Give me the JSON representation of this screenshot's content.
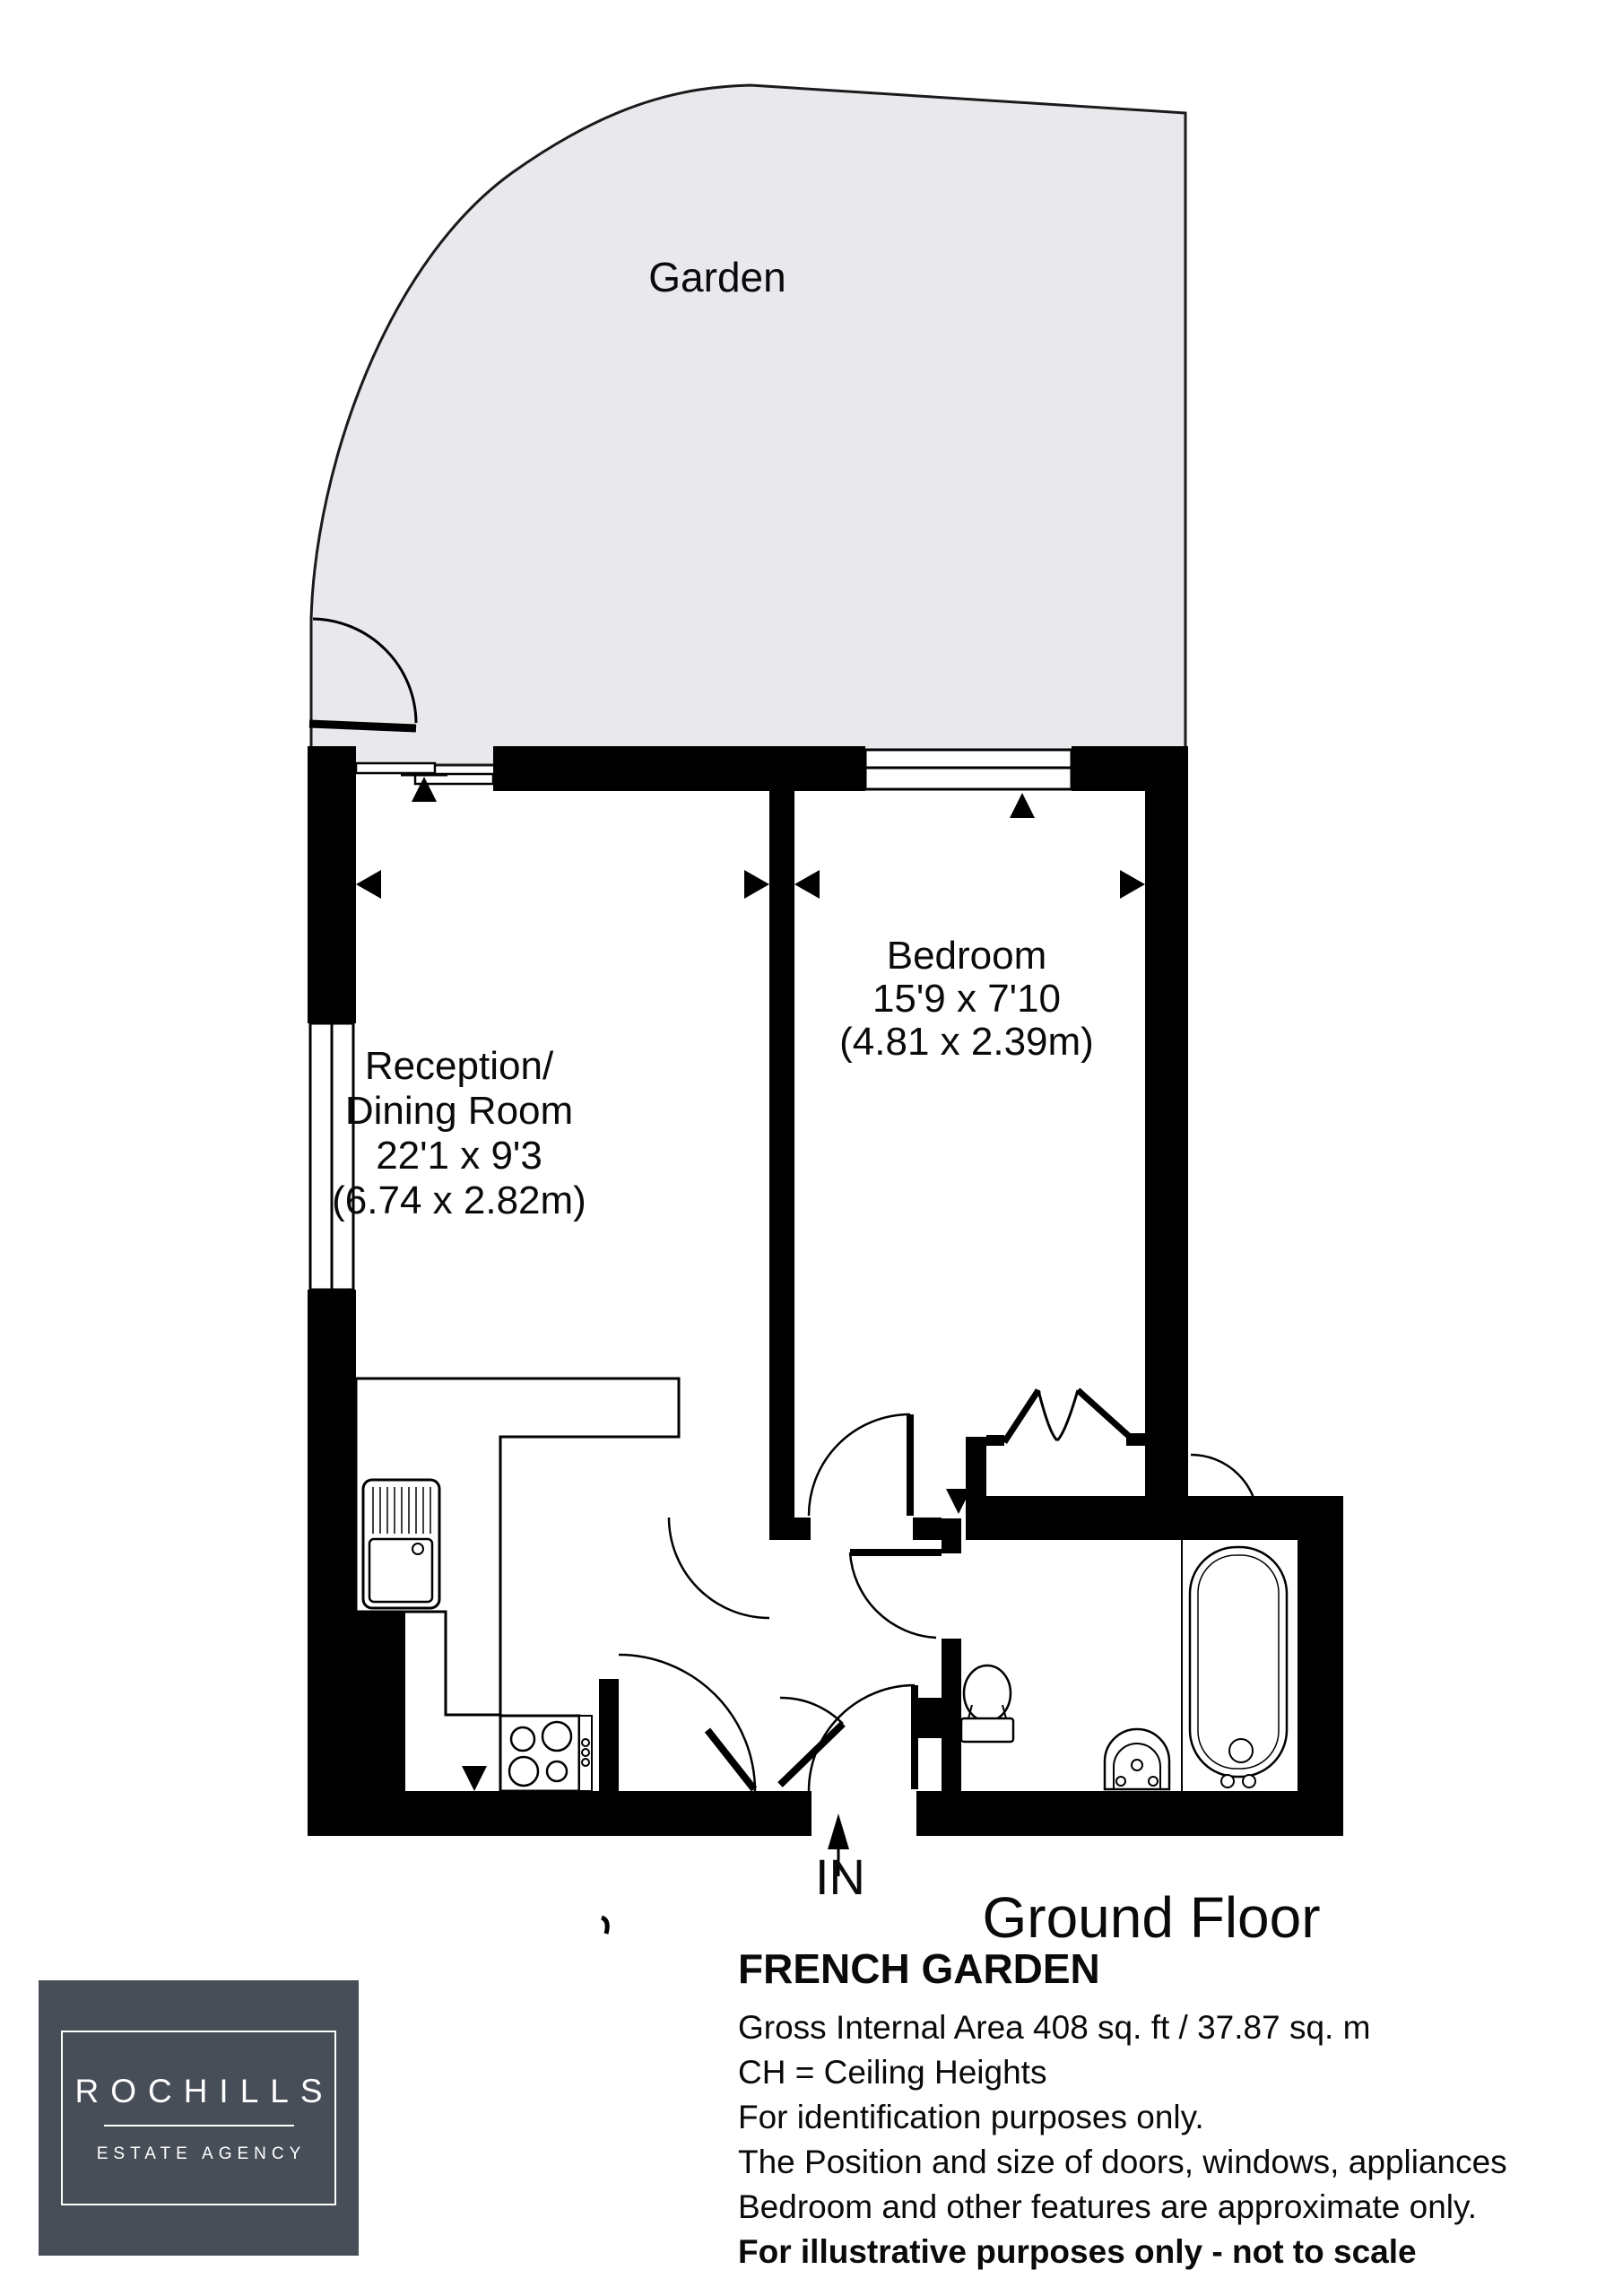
{
  "plan": {
    "garden_label": "Garden",
    "reception": {
      "line1": "Reception/",
      "line2": "Dining Room",
      "line3": "22'1 x 9'3",
      "line4": "(6.74 x 2.82m)"
    },
    "bedroom": {
      "line1": "Bedroom",
      "line2": "15'9 x 7'10",
      "line3": "(4.81 x 2.39m)"
    },
    "floor_label": "Ground Floor",
    "entrance_label": "IN"
  },
  "footer": {
    "logo": {
      "brand": "ROCHILLS",
      "tagline": "ESTATE AGENCY"
    },
    "title": "FRENCH GARDEN",
    "lines": [
      "Gross Internal Area 408 sq. ft / 37.87 sq. m",
      "CH = Ceiling Heights",
      "For identification purposes only.",
      "The Position and size of doors, windows, appliances",
      "Bedroom and other features are approximate only.",
      "For illustrative purposes only - not to scale"
    ]
  },
  "colors": {
    "garden": "#e8e8ed",
    "wall": "#000000",
    "logo_box": "#484e58"
  }
}
